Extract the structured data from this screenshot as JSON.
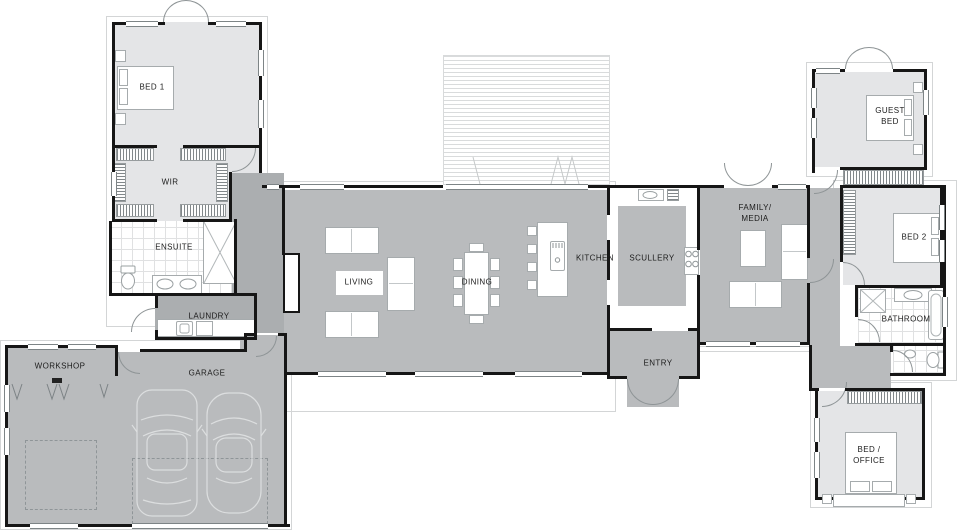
{
  "title": "Single storey house floor plan",
  "colors": {
    "wall": "#161616",
    "light": "#e4e5e7",
    "mid": "#b9bbbd",
    "dark": "#abaeb0"
  },
  "rooms": {
    "bed1": "BED 1",
    "wir": "WIR",
    "ensuite": "ENSUITE",
    "laundry": "LAUNDRY",
    "workshop": "WORKSHOP",
    "garage": "GARAGE",
    "living": "LIVING",
    "dining": "DINING",
    "kitchen": "KITCHEN",
    "scullery": "SCULLERY",
    "family": "FAMILY/\nMEDIA",
    "entry": "ENTRY",
    "guest": "GUEST\nBED",
    "bed2": "BED 2",
    "bathroom": "BATHROOM",
    "bedoffice": "BED /\nOFFICE"
  }
}
